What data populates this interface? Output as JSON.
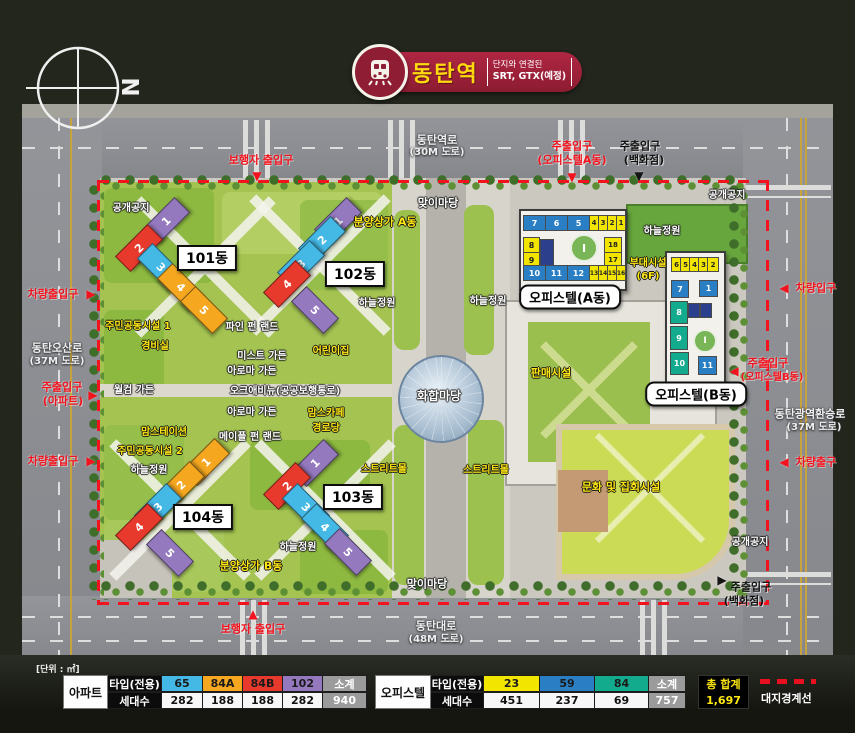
{
  "header": {
    "station": "동탄역",
    "sub_top": "단지와 연결된",
    "sub_bottom": "SRT, GTX(예정)",
    "compass_letter": "N"
  },
  "colors": {
    "cyan": "#45b9e6",
    "orange": "#f4a71f",
    "red": "#e8392d",
    "purple": "#9579bf",
    "yellow": "#f2e600",
    "blue": "#2a7fc4",
    "teal": "#13ab8e",
    "navy": "#2b3f8c",
    "gray": "#9b9b9b",
    "label_red": "#f3131e",
    "boundary_red": "#f3131e"
  },
  "map": {
    "helipad_mark": "I",
    "labels": [
      {
        "t": "동탄역로",
        "x": 437,
        "y": 140,
        "c": "road"
      },
      {
        "t": "(30M 도로)",
        "x": 437,
        "y": 153,
        "c": "road",
        "fs": 10
      },
      {
        "t": "동탄오산로",
        "x": 57,
        "y": 348,
        "c": "road"
      },
      {
        "t": "(37M 도로)",
        "x": 57,
        "y": 362,
        "c": "road",
        "fs": 10
      },
      {
        "t": "동탄대로",
        "x": 436,
        "y": 626,
        "c": "road"
      },
      {
        "t": "(48M 도로)",
        "x": 436,
        "y": 640,
        "c": "road",
        "fs": 10
      },
      {
        "t": "동탄광역환승로",
        "x": 810,
        "y": 414,
        "c": "road"
      },
      {
        "t": "(37M 도로)",
        "x": 814,
        "y": 428,
        "c": "road",
        "fs": 10
      },
      {
        "t": "보행자 출입구",
        "x": 261,
        "y": 160,
        "c": "red"
      },
      {
        "t": "주출입구",
        "x": 572,
        "y": 146,
        "c": "red"
      },
      {
        "t": "(오피스텔A동)",
        "x": 572,
        "y": 160,
        "c": "red",
        "fs": 11
      },
      {
        "t": "주출입구",
        "x": 640,
        "y": 146,
        "c": "black"
      },
      {
        "t": "(백화점)",
        "x": 644,
        "y": 160,
        "c": "black",
        "fs": 11
      },
      {
        "t": "차량출입구",
        "x": 53,
        "y": 294,
        "c": "red"
      },
      {
        "t": "주출입구",
        "x": 62,
        "y": 387,
        "c": "red"
      },
      {
        "t": "(아파트)",
        "x": 63,
        "y": 401,
        "c": "red",
        "fs": 11
      },
      {
        "t": "차량출입구",
        "x": 53,
        "y": 461,
        "c": "red"
      },
      {
        "t": "보행자 출입구",
        "x": 253,
        "y": 629,
        "c": "red"
      },
      {
        "t": "차량입구",
        "x": 816,
        "y": 288,
        "c": "red"
      },
      {
        "t": "주출입구",
        "x": 768,
        "y": 363,
        "c": "red"
      },
      {
        "t": "(오피스텔B동)",
        "x": 772,
        "y": 378,
        "c": "red",
        "fs": 10
      },
      {
        "t": "차량출구",
        "x": 816,
        "y": 462,
        "c": "red"
      },
      {
        "t": "주출입구",
        "x": 751,
        "y": 587,
        "c": "black"
      },
      {
        "t": "(백화점)",
        "x": 744,
        "y": 601,
        "c": "black",
        "fs": 11
      },
      {
        "t": "공개공지",
        "x": 131,
        "y": 209,
        "c": "white",
        "fs": 10
      },
      {
        "t": "공개공지",
        "x": 727,
        "y": 196,
        "c": "white",
        "fs": 10
      },
      {
        "t": "공개공지",
        "x": 750,
        "y": 543,
        "c": "white",
        "fs": 10
      },
      {
        "t": "맞이마당",
        "x": 438,
        "y": 203,
        "c": "white"
      },
      {
        "t": "맞이마당",
        "x": 427,
        "y": 584,
        "c": "white"
      },
      {
        "t": "하늘정원",
        "x": 377,
        "y": 304,
        "c": "white",
        "fs": 10
      },
      {
        "t": "하늘정원",
        "x": 488,
        "y": 302,
        "c": "white",
        "fs": 10
      },
      {
        "t": "하늘정원",
        "x": 662,
        "y": 232,
        "c": "white",
        "fs": 10
      },
      {
        "t": "하늘정원",
        "x": 149,
        "y": 471,
        "c": "white",
        "fs": 10
      },
      {
        "t": "하늘정원",
        "x": 298,
        "y": 548,
        "c": "white",
        "fs": 10
      },
      {
        "t": "화합마당",
        "x": 439,
        "y": 396,
        "c": "white",
        "fs": 12
      },
      {
        "t": "월컴 가든",
        "x": 134,
        "y": 391,
        "c": "white",
        "fs": 10
      },
      {
        "t": "파인 펀 랜드",
        "x": 252,
        "y": 328,
        "c": "white",
        "fs": 10
      },
      {
        "t": "미스트 가든",
        "x": 262,
        "y": 357,
        "c": "white",
        "fs": 10
      },
      {
        "t": "아로마 가든",
        "x": 252,
        "y": 372,
        "c": "white",
        "fs": 10
      },
      {
        "t": "오크애비뉴(공공보행통로)",
        "x": 285,
        "y": 392,
        "c": "white",
        "fs": 10
      },
      {
        "t": "아로마 가든",
        "x": 252,
        "y": 413,
        "c": "white",
        "fs": 10
      },
      {
        "t": "메이플 펀 랜드",
        "x": 250,
        "y": 438,
        "c": "white",
        "fs": 10
      },
      {
        "t": "분양상가 A동",
        "x": 385,
        "y": 222,
        "c": "yellow"
      },
      {
        "t": "분양상가 B동",
        "x": 251,
        "y": 566,
        "c": "yellow"
      },
      {
        "t": "주민공동시설 1",
        "x": 138,
        "y": 327,
        "c": "yellow",
        "fs": 10
      },
      {
        "t": "경비실",
        "x": 155,
        "y": 347,
        "c": "yellow",
        "fs": 10
      },
      {
        "t": "맘스테이션",
        "x": 164,
        "y": 433,
        "c": "yellow",
        "fs": 10
      },
      {
        "t": "주민공동시설 2",
        "x": 150,
        "y": 452,
        "c": "yellow",
        "fs": 10
      },
      {
        "t": "어린이집",
        "x": 331,
        "y": 352,
        "c": "yellow",
        "fs": 10
      },
      {
        "t": "맘스카페",
        "x": 326,
        "y": 414,
        "c": "yellow",
        "fs": 10
      },
      {
        "t": "경로당",
        "x": 326,
        "y": 429,
        "c": "yellow",
        "fs": 10
      },
      {
        "t": "스트리트몰",
        "x": 384,
        "y": 470,
        "c": "yellow",
        "fs": 10
      },
      {
        "t": "스트리트몰",
        "x": 486,
        "y": 471,
        "c": "yellow",
        "fs": 10
      },
      {
        "t": "판매시설",
        "x": 551,
        "y": 373,
        "c": "yellow"
      },
      {
        "t": "부대시설",
        "x": 648,
        "y": 264,
        "c": "yellow",
        "fs": 10
      },
      {
        "t": "(6F)",
        "x": 648,
        "y": 277,
        "c": "yellow",
        "fs": 10
      },
      {
        "t": "문화 및 집회시설",
        "x": 621,
        "y": 487,
        "c": "yellow"
      }
    ],
    "arrows": [
      {
        "s": "▼",
        "x": 257,
        "y": 176,
        "c": "red"
      },
      {
        "s": "▼",
        "x": 572,
        "y": 177,
        "c": "red"
      },
      {
        "s": "▼",
        "x": 639,
        "y": 176,
        "c": "black"
      },
      {
        "s": "▶",
        "x": 91,
        "y": 294,
        "c": "red"
      },
      {
        "s": "▶",
        "x": 93,
        "y": 395,
        "c": "red"
      },
      {
        "s": "▶",
        "x": 91,
        "y": 461,
        "c": "red"
      },
      {
        "s": "▲",
        "x": 253,
        "y": 614,
        "c": "red"
      },
      {
        "s": "◀",
        "x": 784,
        "y": 288,
        "c": "red"
      },
      {
        "s": "◀",
        "x": 734,
        "y": 371,
        "c": "red"
      },
      {
        "s": "◀",
        "x": 784,
        "y": 462,
        "c": "red"
      },
      {
        "s": "▶",
        "x": 722,
        "y": 580,
        "c": "black"
      }
    ],
    "apartments": [
      {
        "name": "101동",
        "lx": 207,
        "ly": 258,
        "segments": [
          {
            "n": "1",
            "x": 166,
            "y": 221,
            "col": "purple",
            "r": -45
          },
          {
            "n": "2",
            "x": 139,
            "y": 248,
            "col": "red",
            "r": -45
          },
          {
            "n": "3",
            "x": 161,
            "y": 267,
            "col": "cyan",
            "r": 45
          },
          {
            "n": "4",
            "x": 181,
            "y": 287,
            "col": "orange",
            "r": 45
          },
          {
            "n": "5",
            "x": 204,
            "y": 310,
            "col": "orange",
            "r": 45
          }
        ]
      },
      {
        "name": "102동",
        "lx": 355,
        "ly": 274,
        "segments": [
          {
            "n": "1",
            "x": 338,
            "y": 221,
            "col": "purple",
            "r": -45
          },
          {
            "n": "2",
            "x": 322,
            "y": 240,
            "col": "cyan",
            "r": -45
          },
          {
            "n": "3",
            "x": 301,
            "y": 264,
            "col": "cyan",
            "r": -45
          },
          {
            "n": "4",
            "x": 287,
            "y": 284,
            "col": "red",
            "r": -45
          },
          {
            "n": "5",
            "x": 315,
            "y": 310,
            "col": "purple",
            "r": 45
          }
        ]
      },
      {
        "name": "103동",
        "lx": 353,
        "ly": 497,
        "segments": [
          {
            "n": "1",
            "x": 315,
            "y": 463,
            "col": "purple",
            "r": -45
          },
          {
            "n": "2",
            "x": 287,
            "y": 486,
            "col": "red",
            "r": -45
          },
          {
            "n": "3",
            "x": 306,
            "y": 507,
            "col": "cyan",
            "r": 45
          },
          {
            "n": "4",
            "x": 325,
            "y": 527,
            "col": "cyan",
            "r": 45
          },
          {
            "n": "5",
            "x": 348,
            "y": 552,
            "col": "purple",
            "r": 45
          }
        ]
      },
      {
        "name": "104동",
        "lx": 203,
        "ly": 517,
        "segments": [
          {
            "n": "1",
            "x": 206,
            "y": 462,
            "col": "orange",
            "r": -45
          },
          {
            "n": "2",
            "x": 181,
            "y": 485,
            "col": "orange",
            "r": -45
          },
          {
            "n": "3",
            "x": 158,
            "y": 507,
            "col": "cyan",
            "r": -45
          },
          {
            "n": "4",
            "x": 139,
            "y": 527,
            "col": "red",
            "r": -45
          },
          {
            "n": "5",
            "x": 170,
            "y": 553,
            "col": "purple",
            "r": 45
          }
        ]
      }
    ],
    "officetel_a": {
      "name": "오피스텔(A동)",
      "label": {
        "x": 570,
        "y": 297
      },
      "cells": [
        {
          "n": "7",
          "x": 523,
          "y": 215,
          "w": 21,
          "h": 14,
          "col": "blue"
        },
        {
          "n": "6",
          "x": 545,
          "y": 215,
          "w": 21,
          "h": 14,
          "col": "blue"
        },
        {
          "n": "5",
          "x": 567,
          "y": 215,
          "w": 21,
          "h": 14,
          "col": "blue"
        },
        {
          "n": "4",
          "x": 589,
          "y": 215,
          "w": 8,
          "h": 14,
          "col": "yellow",
          "fs": 7
        },
        {
          "n": "3",
          "x": 598,
          "y": 215,
          "w": 8,
          "h": 14,
          "col": "yellow",
          "fs": 7
        },
        {
          "n": "2",
          "x": 607,
          "y": 215,
          "w": 8,
          "h": 14,
          "col": "yellow",
          "fs": 7
        },
        {
          "n": "1",
          "x": 616,
          "y": 215,
          "w": 8,
          "h": 14,
          "col": "yellow",
          "fs": 7
        },
        {
          "n": "8",
          "x": 523,
          "y": 237,
          "w": 15,
          "h": 14,
          "col": "yellow"
        },
        {
          "n": "9",
          "x": 523,
          "y": 252,
          "w": 15,
          "h": 14,
          "col": "yellow"
        },
        {
          "n": "",
          "x": 540,
          "y": 239,
          "w": 12,
          "h": 27,
          "col": "navy"
        },
        {
          "n": "18",
          "x": 604,
          "y": 237,
          "w": 16,
          "h": 14,
          "col": "yellow",
          "fs": 7
        },
        {
          "n": "17",
          "x": 604,
          "y": 252,
          "w": 16,
          "h": 14,
          "col": "yellow",
          "fs": 7
        },
        {
          "n": "10",
          "x": 523,
          "y": 265,
          "w": 21,
          "h": 14,
          "col": "blue"
        },
        {
          "n": "11",
          "x": 545,
          "y": 265,
          "w": 21,
          "h": 14,
          "col": "blue"
        },
        {
          "n": "12",
          "x": 567,
          "y": 265,
          "w": 21,
          "h": 14,
          "col": "blue"
        },
        {
          "n": "13",
          "x": 589,
          "y": 265,
          "w": 8,
          "h": 14,
          "col": "yellow",
          "fs": 6
        },
        {
          "n": "14",
          "x": 598,
          "y": 265,
          "w": 8,
          "h": 14,
          "col": "yellow",
          "fs": 6
        },
        {
          "n": "15",
          "x": 607,
          "y": 265,
          "w": 8,
          "h": 14,
          "col": "yellow",
          "fs": 6
        },
        {
          "n": "16",
          "x": 616,
          "y": 265,
          "w": 8,
          "h": 14,
          "col": "yellow",
          "fs": 6
        }
      ]
    },
    "officetel_b": {
      "name": "오피스텔(B동)",
      "label": {
        "x": 696,
        "y": 394
      },
      "cells": [
        {
          "n": "6",
          "x": 671,
          "y": 257,
          "w": 9,
          "h": 13,
          "col": "yellow",
          "fs": 7
        },
        {
          "n": "5",
          "x": 680,
          "y": 257,
          "w": 9,
          "h": 13,
          "col": "yellow",
          "fs": 7
        },
        {
          "n": "4",
          "x": 689,
          "y": 257,
          "w": 9,
          "h": 13,
          "col": "yellow",
          "fs": 7
        },
        {
          "n": "3",
          "x": 698,
          "y": 257,
          "w": 9,
          "h": 13,
          "col": "yellow",
          "fs": 7
        },
        {
          "n": "2",
          "x": 707,
          "y": 257,
          "w": 10,
          "h": 13,
          "col": "yellow",
          "fs": 7
        },
        {
          "n": "7",
          "x": 671,
          "y": 280,
          "w": 16,
          "h": 16,
          "col": "blue"
        },
        {
          "n": "1",
          "x": 699,
          "y": 280,
          "w": 17,
          "h": 15,
          "col": "blue"
        },
        {
          "n": "",
          "x": 688,
          "y": 303,
          "w": 10,
          "h": 13,
          "col": "navy"
        },
        {
          "n": "",
          "x": 700,
          "y": 303,
          "w": 10,
          "h": 13,
          "col": "navy"
        },
        {
          "n": "8",
          "x": 670,
          "y": 301,
          "w": 16,
          "h": 21,
          "col": "teal"
        },
        {
          "n": "9",
          "x": 670,
          "y": 326,
          "w": 16,
          "h": 22,
          "col": "teal"
        },
        {
          "n": "10",
          "x": 670,
          "y": 352,
          "w": 17,
          "h": 21,
          "col": "teal"
        },
        {
          "n": "11",
          "x": 698,
          "y": 356,
          "w": 17,
          "h": 17,
          "col": "blue"
        }
      ]
    }
  },
  "units_table": {
    "unit_note": "[단위 : ㎡]",
    "apartment": {
      "group": "아파트",
      "row1_header": "타입(전용)",
      "row2_header": "세대수",
      "cols": [
        {
          "t": "65",
          "v": "282",
          "col": "#45b9e6",
          "w": 41
        },
        {
          "t": "84A",
          "v": "188",
          "col": "#f4a71f",
          "w": 40
        },
        {
          "t": "84B",
          "v": "188",
          "col": "#e8392d",
          "w": 40
        },
        {
          "t": "102",
          "v": "282",
          "col": "#9579bf",
          "w": 40
        },
        {
          "t": "소계",
          "v": "940",
          "col": "#9b9b9b",
          "w": 44,
          "sub": true
        }
      ]
    },
    "officetel": {
      "group": "오피스텔",
      "row1_header": "타입(전용)",
      "row2_header": "세대수",
      "cols": [
        {
          "t": "23",
          "v": "451",
          "col": "#f2e600",
          "w": 56
        },
        {
          "t": "59",
          "v": "237",
          "col": "#2a7fc4",
          "w": 55
        },
        {
          "t": "84",
          "v": "69",
          "col": "#13ab8e",
          "w": 54
        },
        {
          "t": "소계",
          "v": "757",
          "col": "#9b9b9b",
          "w": 37,
          "sub": true
        }
      ]
    },
    "total": {
      "label": "총 합계",
      "value": "1,697"
    },
    "boundary_legend": "대지경계선"
  }
}
